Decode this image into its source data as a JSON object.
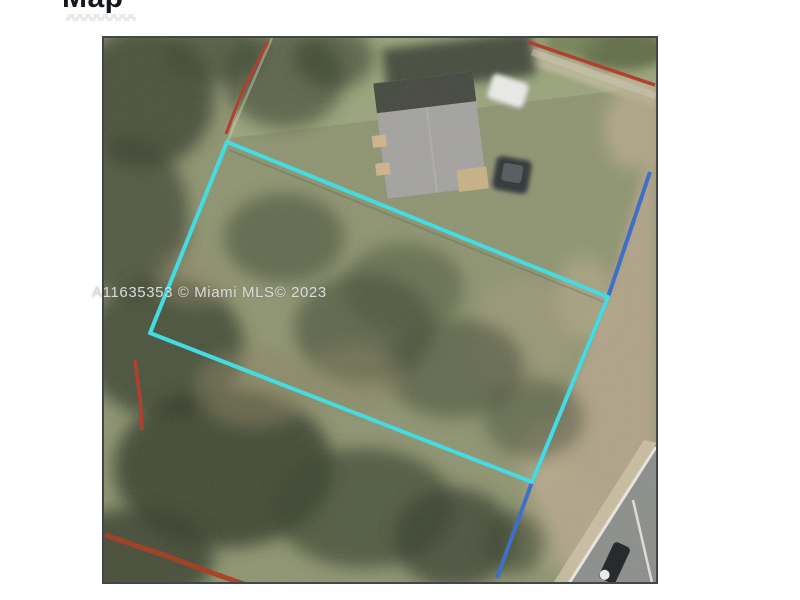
{
  "page": {
    "title": "Map"
  },
  "watermark": {
    "text": "A11635353 © Miami MLS© 2023"
  },
  "map": {
    "colors": {
      "parcel_outline": "#3fdde4",
      "road_overlay": "#3a6cc8",
      "survey_red": "#b23b28",
      "frame_border": "#43474a"
    }
  }
}
